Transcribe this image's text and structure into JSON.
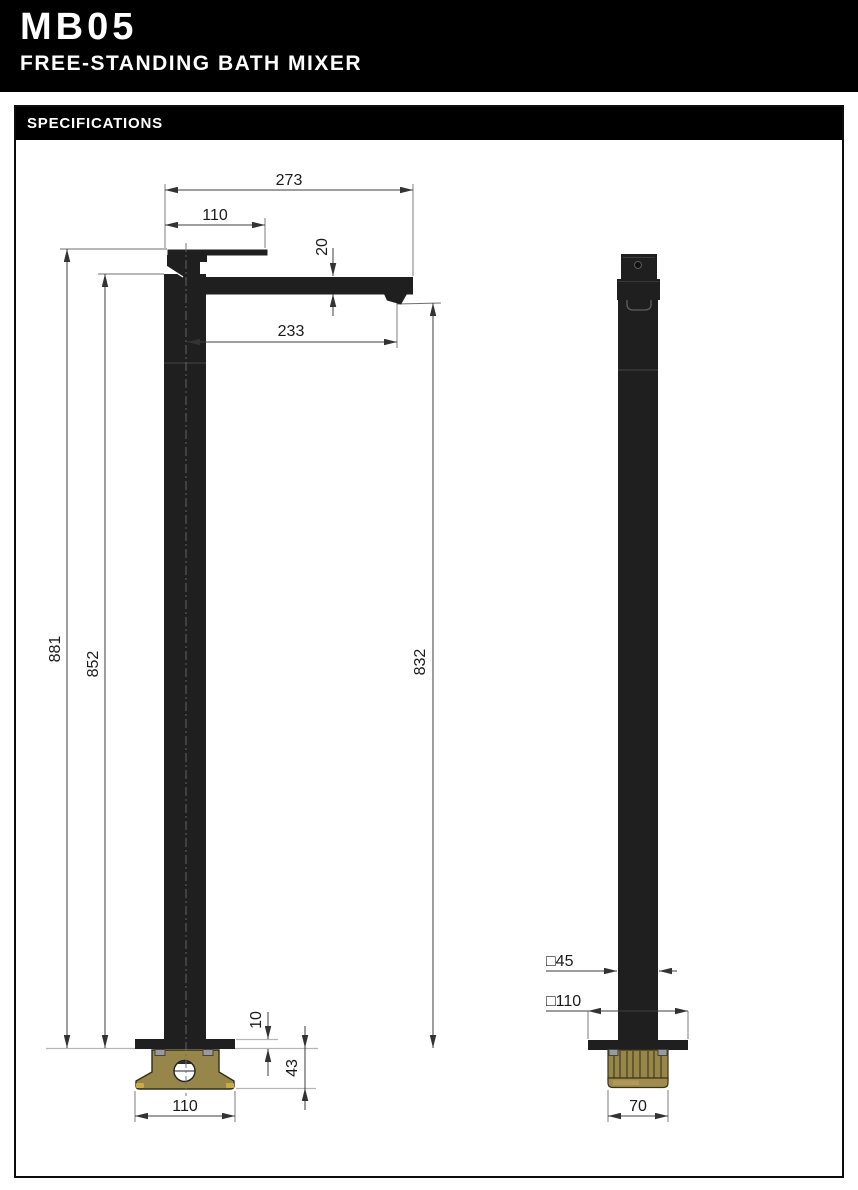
{
  "header": {
    "model": "MB05",
    "product_name": "FREE-STANDING BATH MIXER"
  },
  "spec_box": {
    "title": "SPECIFICATIONS"
  },
  "front_view": {
    "dims": {
      "overall_width": "273",
      "handle_length": "110",
      "spout_thickness": "20",
      "spout_reach": "233",
      "overall_height": "881",
      "spout_top_height": "852",
      "outlet_height": "832",
      "flange_thickness": "10",
      "base_depth": "43",
      "base_width": "110"
    }
  },
  "side_view": {
    "dims": {
      "post_square": "□45",
      "flange_square": "□110",
      "fitting_width": "70"
    }
  },
  "colors": {
    "body_black": "#1f1f1f",
    "brass": "#97864a",
    "brass_dark_line": "#4a421f",
    "brass_accent": "#c9aa45",
    "bolt_gray": "#9a9a9a"
  }
}
